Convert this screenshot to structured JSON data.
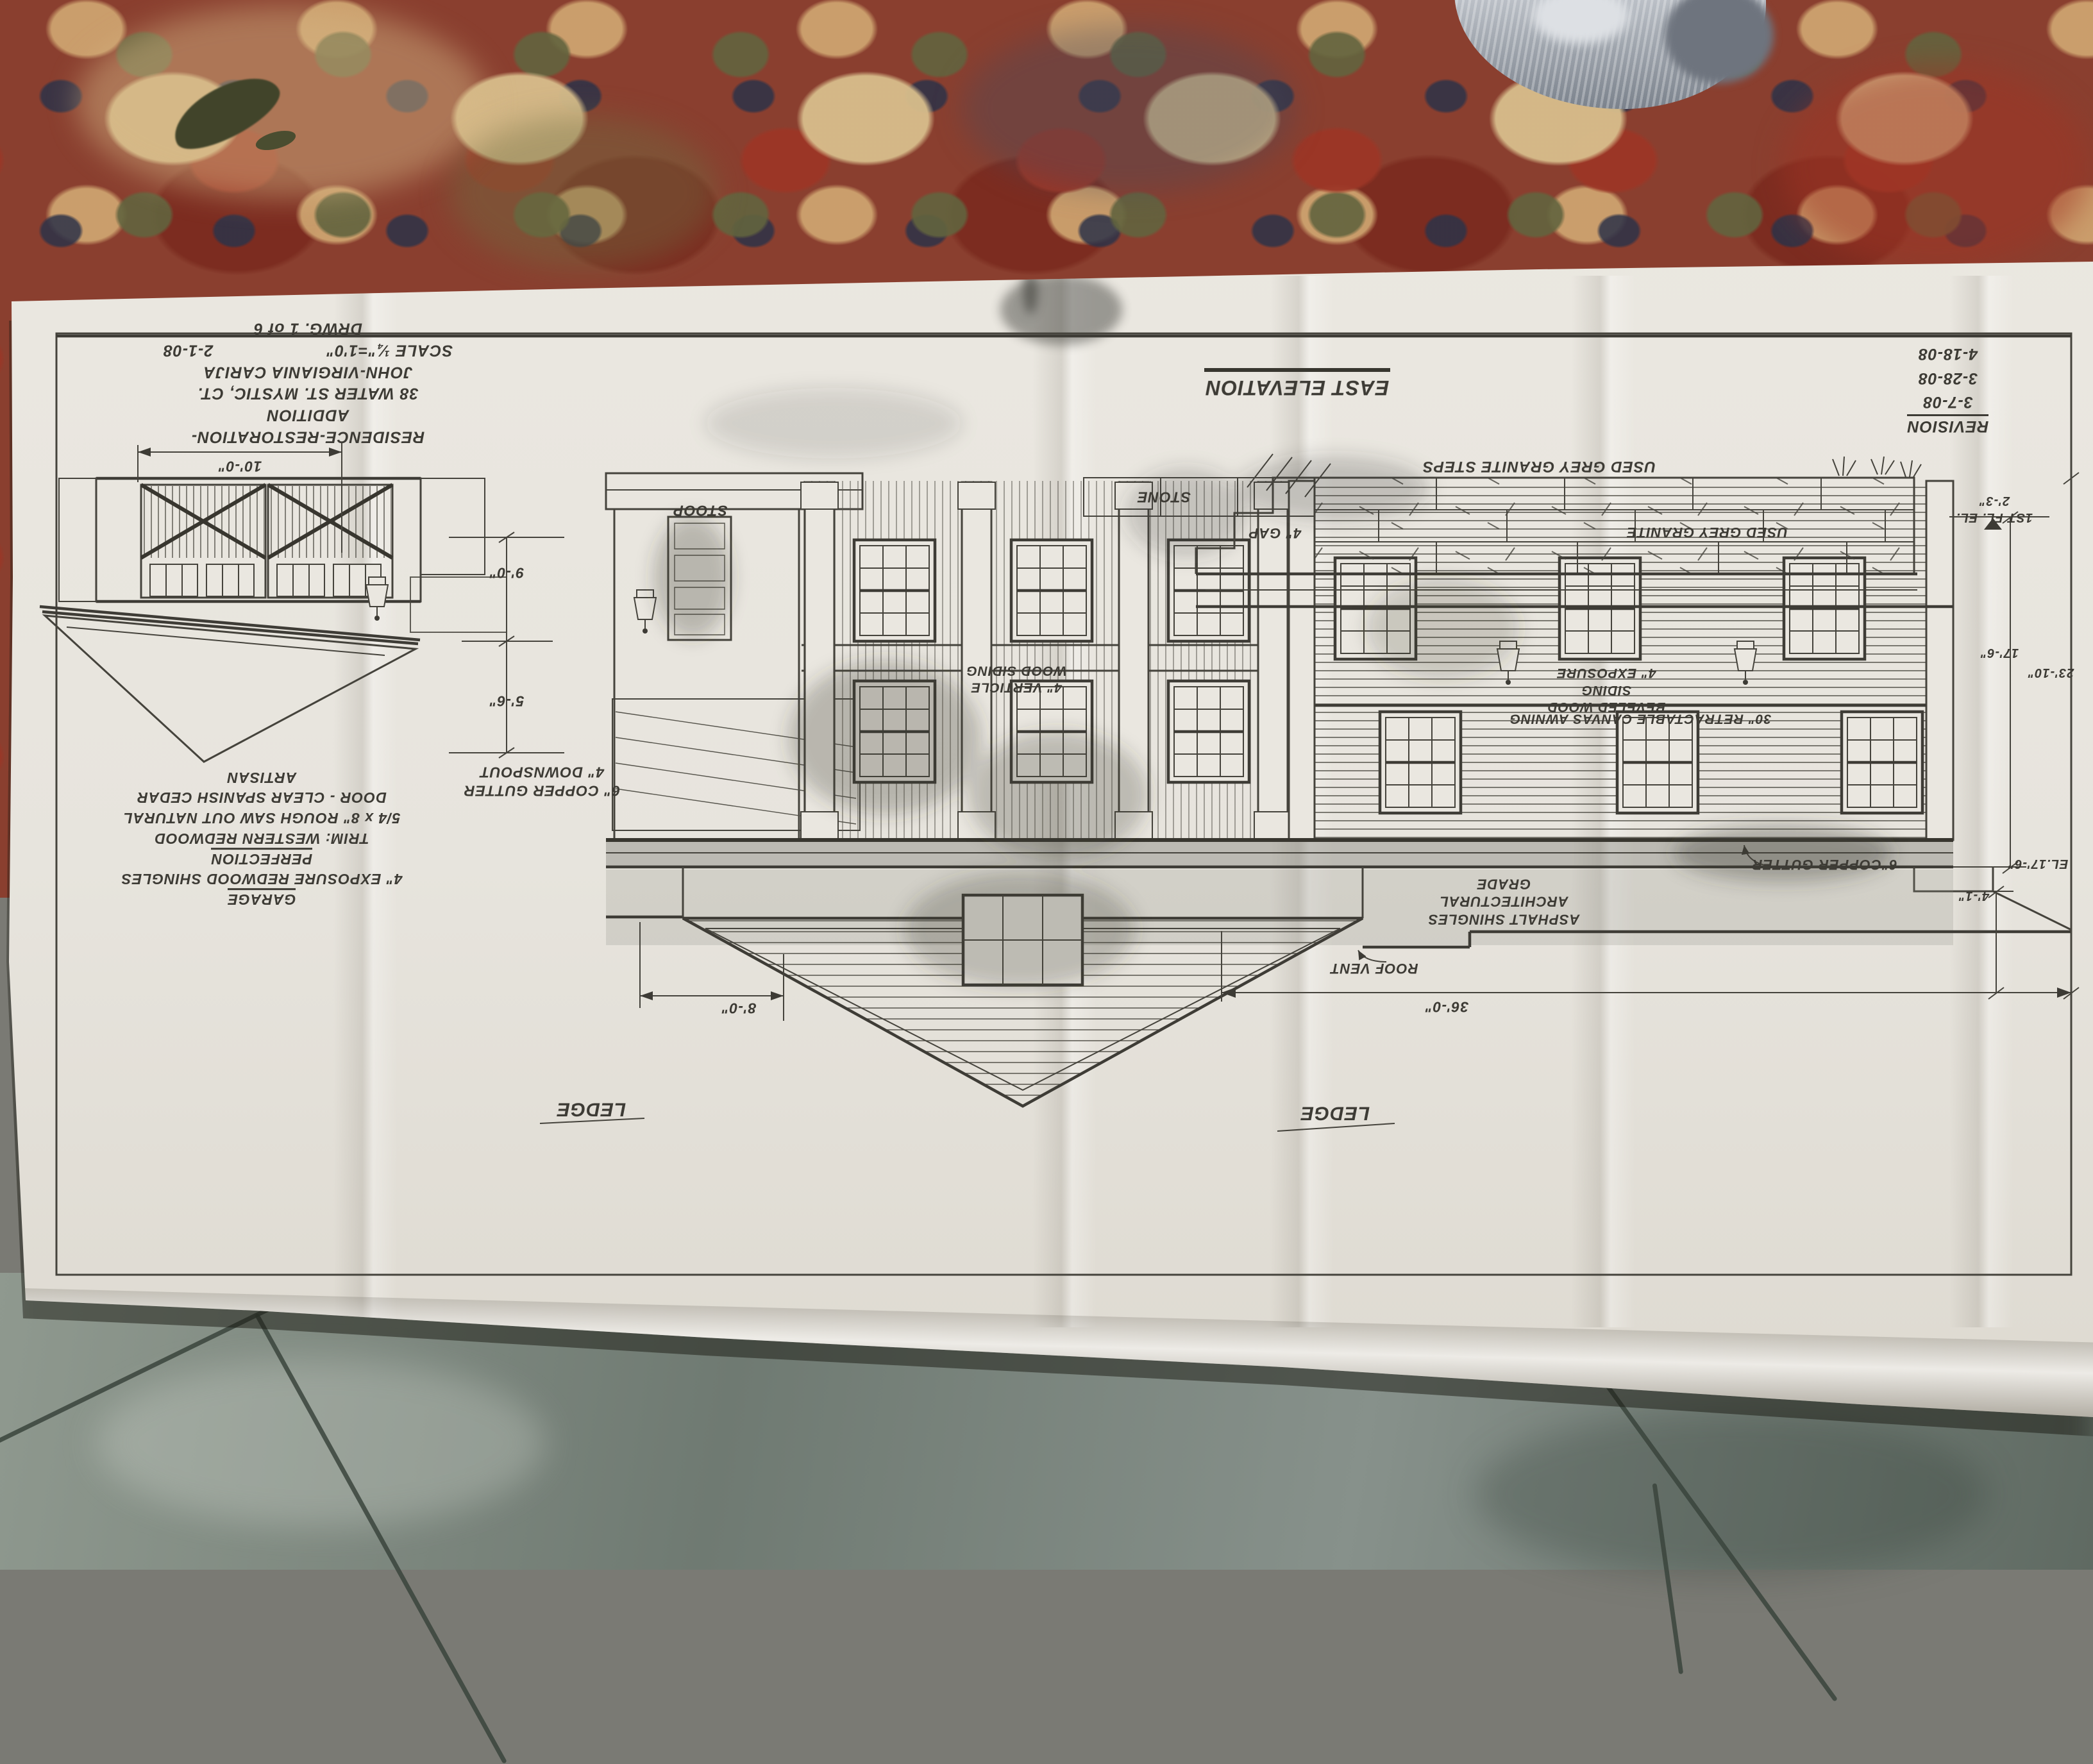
{
  "drawing": {
    "east_elevation": "EAST ELEVATION",
    "revision": {
      "title": "REVISION",
      "dates": [
        "3-7-08",
        "3-28-08",
        "4-18-08"
      ]
    },
    "title_block": {
      "project": "RESIDENCE-RESTORATION-ADDITION",
      "address": "38 WATER ST. MYSTIC, CT.",
      "client": "JOHN-VIRGIANIA CARIJA",
      "scale": "SCALE ¼\"=1'0\"",
      "date": "2-1-08",
      "sheet": "DRWG. 1 of 6"
    },
    "garage_notes": {
      "title": "GARAGE",
      "shingles": "4\" EXPOSURE REDWOOD SHINGLES",
      "brand": "PERFECTION",
      "trim": "TRIM: WESTERN REDWOOD",
      "trim2": "5/4 x 8\" ROUGH SAW OUT NATURAL",
      "door": "DOOR - CLEAR SPANISH CEDAR",
      "door2": "ARTISAN"
    },
    "labels": {
      "stoop": "STOOP",
      "stone": "STONE",
      "gap": "4\" GAP",
      "granite_steps": "USED GREY GRANITE STEPS",
      "granite_wall": "USED GREY GRANITE",
      "beveled1": "BEVELED WOOD SIDING",
      "beveled2": "4\" EXPOSURE",
      "awning": "30\" RETRACTABLE CANVAS AWNING",
      "vert1": "4\" VERTICLE",
      "vert2": "WOOD SIDING",
      "gutter_left1": "6\" COPPER GUTTER",
      "gutter_left2": "4\" DOWNSPOUT",
      "gutter_right": "6\"COPPER GUTTER",
      "asphalt1": "ASPHALT SHINGLES",
      "asphalt2": "ARCHITECTURAL GRADE",
      "roof_vent": "ROOF VENT",
      "ledge": "LEDGE"
    },
    "dims": {
      "garage_width": "10'-0\"",
      "left_upper": "9'-0\"",
      "left_lower": "5'-6\"",
      "gable_width": "8'-0\"",
      "house_width": "36'-0\"",
      "first_floor_label": "1ST FL. EL.",
      "first_floor_value": "2'-3\"",
      "right_mid": "17'-6\"",
      "right_overall": "23'-10\"",
      "eave_el": "EL.17'-6\"",
      "eave_offset": "4'-1\""
    }
  },
  "colors": {
    "paper": "#e7e4dd",
    "ink": "#3d3b35",
    "carpet_red": "#8a3f2f",
    "tile_grey": "#7f8a81"
  }
}
